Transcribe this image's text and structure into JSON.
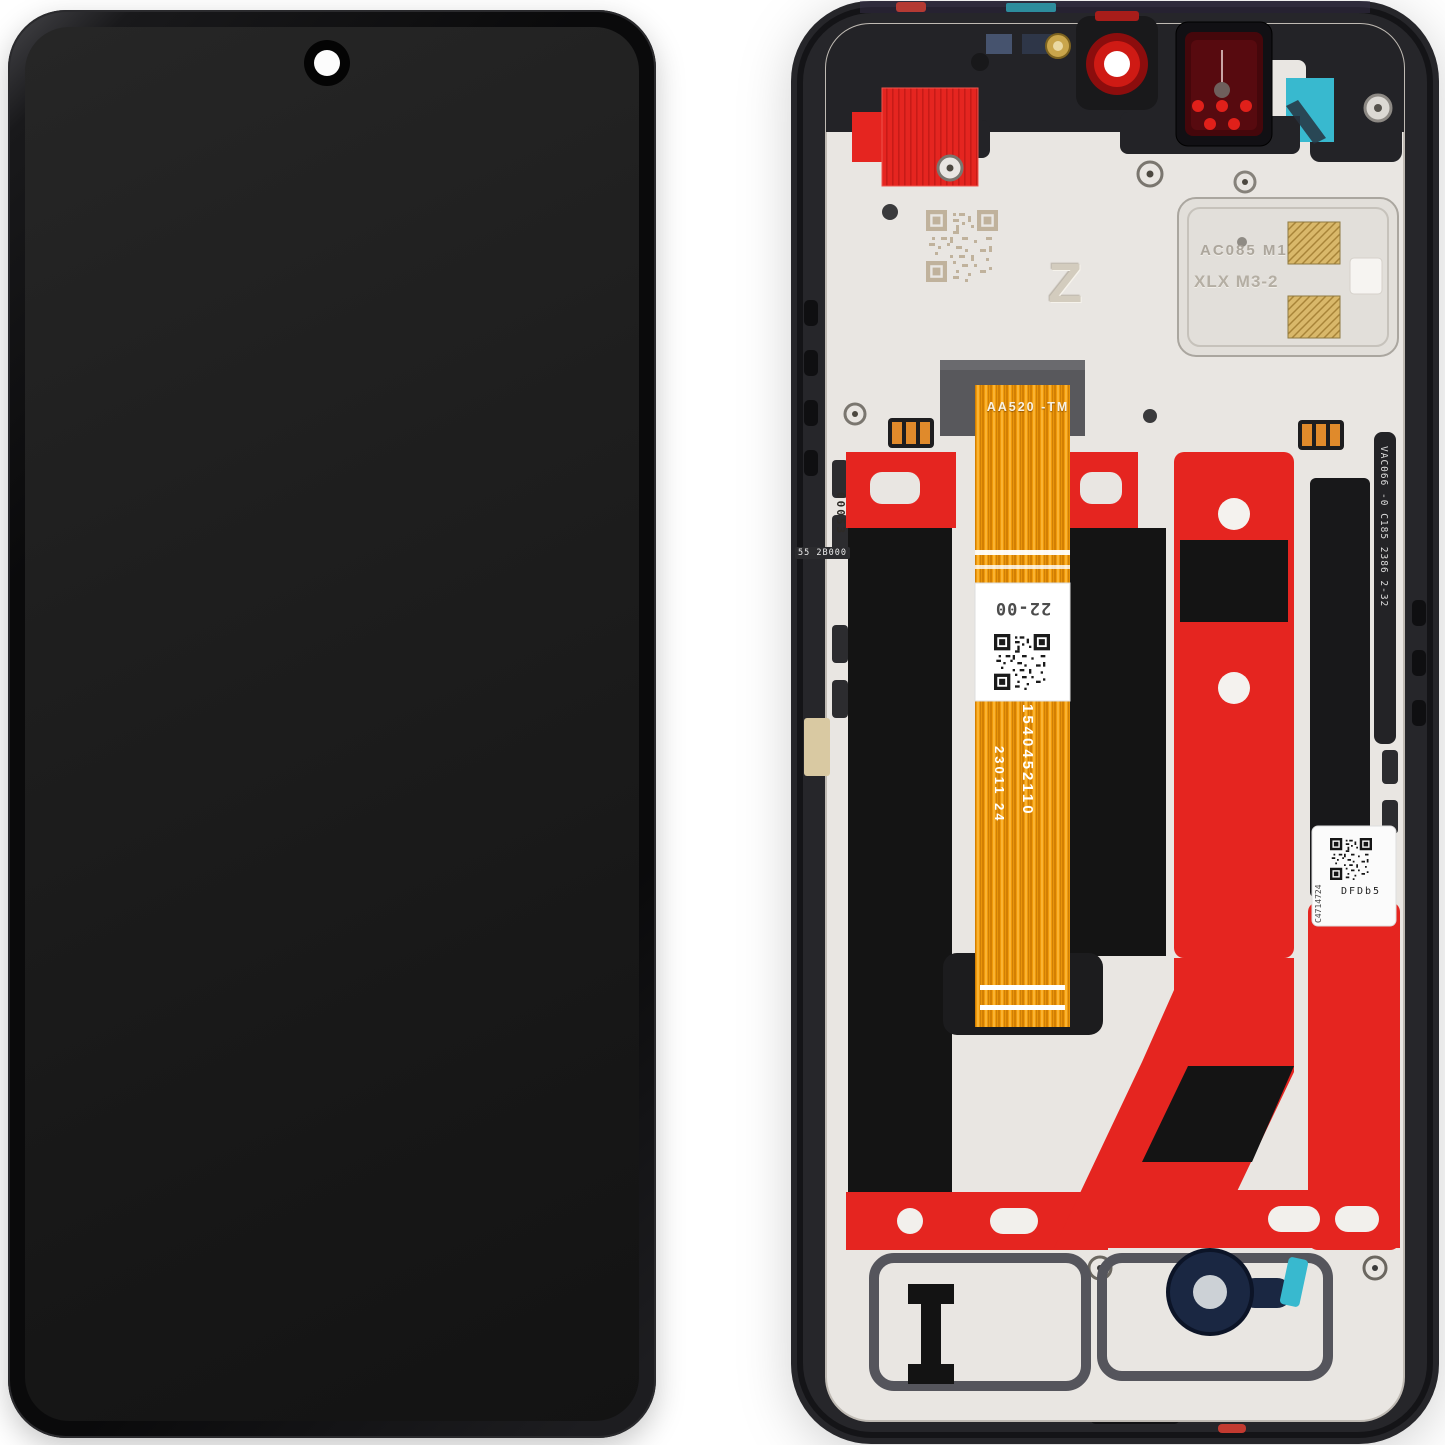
{
  "back_assembly": {
    "main_flex": {
      "model_marking": "AA520 -TM",
      "label_code": "22-00",
      "serial_marking": "1540452110",
      "date_marking": "23011 24"
    },
    "left_edge": {
      "vertical_code": "00053",
      "small_code": "55 2B000"
    },
    "right_edge_flex_code": "VAC066 -0 C185 2386 2-32",
    "speaker_module": {
      "marking_line1": "AC085 M1",
      "marking_line2": "XLX M3-2"
    },
    "shield_etched_letter": "Z",
    "service_label": {
      "serial": "C4714724",
      "code": "DFDb5"
    }
  },
  "colors": {
    "frame_black": "#26262a",
    "plate_silver": "#e9e6e2",
    "tape_red": "#e52520",
    "flex_orange": "#f09a0a",
    "adhesive_teal": "#38b9cf",
    "gold_pad": "#d9b86a",
    "grommet_navy": "#1a2742",
    "sensor_red": "#45070b",
    "camera_red": "#cf1a14",
    "panel_black": "#141414"
  }
}
